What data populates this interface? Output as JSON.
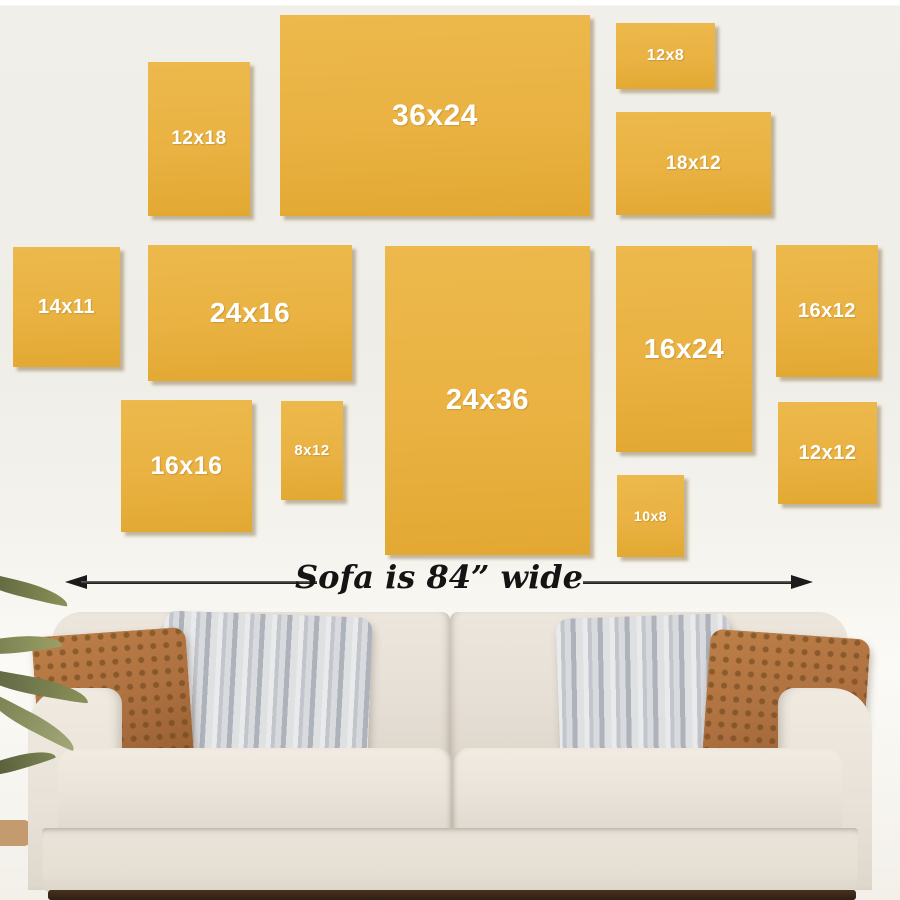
{
  "wall_guide": {
    "frames": [
      {
        "id": "12x18",
        "label": "12x18"
      },
      {
        "id": "36x24",
        "label": "36x24"
      },
      {
        "id": "12x8",
        "label": "12x8"
      },
      {
        "id": "18x12",
        "label": "18x12"
      },
      {
        "id": "14x11",
        "label": "14x11"
      },
      {
        "id": "24x16",
        "label": "24x16"
      },
      {
        "id": "24x36",
        "label": "24x36"
      },
      {
        "id": "16x24",
        "label": "16x24"
      },
      {
        "id": "16x12",
        "label": "16x12"
      },
      {
        "id": "16x16",
        "label": "16x16"
      },
      {
        "id": "8x12",
        "label": "8x12"
      },
      {
        "id": "12x12",
        "label": "12x12"
      },
      {
        "id": "10x8",
        "label": "10x8"
      }
    ],
    "caption": "Sofa is 84” wide"
  },
  "icons": {
    "arrow_left": "left-arrowhead-icon",
    "arrow_right": "right-arrowhead-icon"
  },
  "colors": {
    "canvas_yellow": "#E9B242",
    "canvas_shadow": "#7A602C",
    "wall": "#F1EFE9",
    "label_text": "#FFFFFF",
    "arrow_black": "#1B1B1B",
    "sofa_fabric": "#E7E1D7",
    "pillow_brown": "#AD7040",
    "pillow_gray": "#C9CCD2",
    "plant_leaf": "#7C8452",
    "floor_dark": "#46311F"
  }
}
